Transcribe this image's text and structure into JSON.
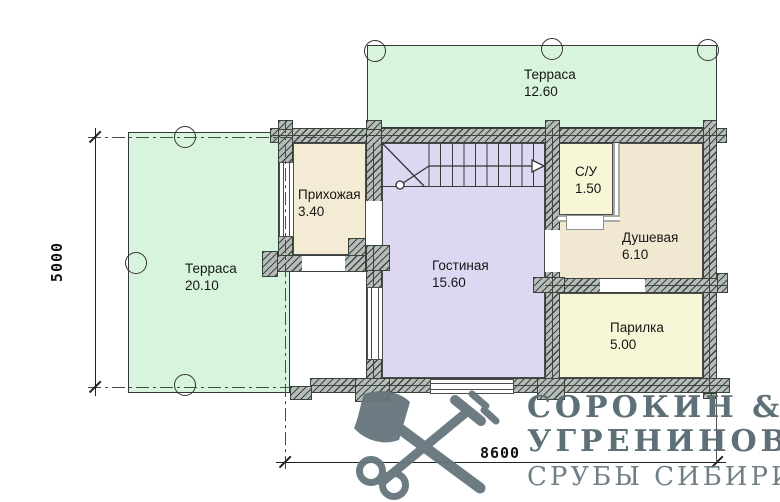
{
  "plan": {
    "rooms": [
      {
        "id": "terrace-top",
        "label": "Терраса",
        "area": "12.60",
        "color": "#d9f4dc"
      },
      {
        "id": "terrace-left",
        "label": "Терраса",
        "area": "20.10",
        "color": "#d9f4dc"
      },
      {
        "id": "hallway",
        "label": "Прихожая",
        "area": "3.40",
        "color": "#f3ebd3"
      },
      {
        "id": "living-room",
        "label": "Гостиная",
        "area": "15.60",
        "color": "#ddd7f2"
      },
      {
        "id": "wc",
        "label": "С/У",
        "area": "1.50",
        "color": "#f7f6d6"
      },
      {
        "id": "shower",
        "label": "Душевая",
        "area": "6.10",
        "color": "#f1e8d1"
      },
      {
        "id": "sauna",
        "label": "Парилка",
        "area": "5.00",
        "color": "#f7f6d6"
      }
    ],
    "dimensions": {
      "height_mm": "5000",
      "width_mm": "8600"
    }
  },
  "logo": {
    "line1": "СОРОКИН &",
    "line2": "УГРЕНИНОВ",
    "line3": "СРУБЫ СИБИРИ",
    "icon": "axe-and-key-icon",
    "color": "#5d6f77"
  },
  "colors": {
    "wall_fill": "#b6bcb7",
    "wall_hatch": "#26302b",
    "line": "#333333"
  }
}
